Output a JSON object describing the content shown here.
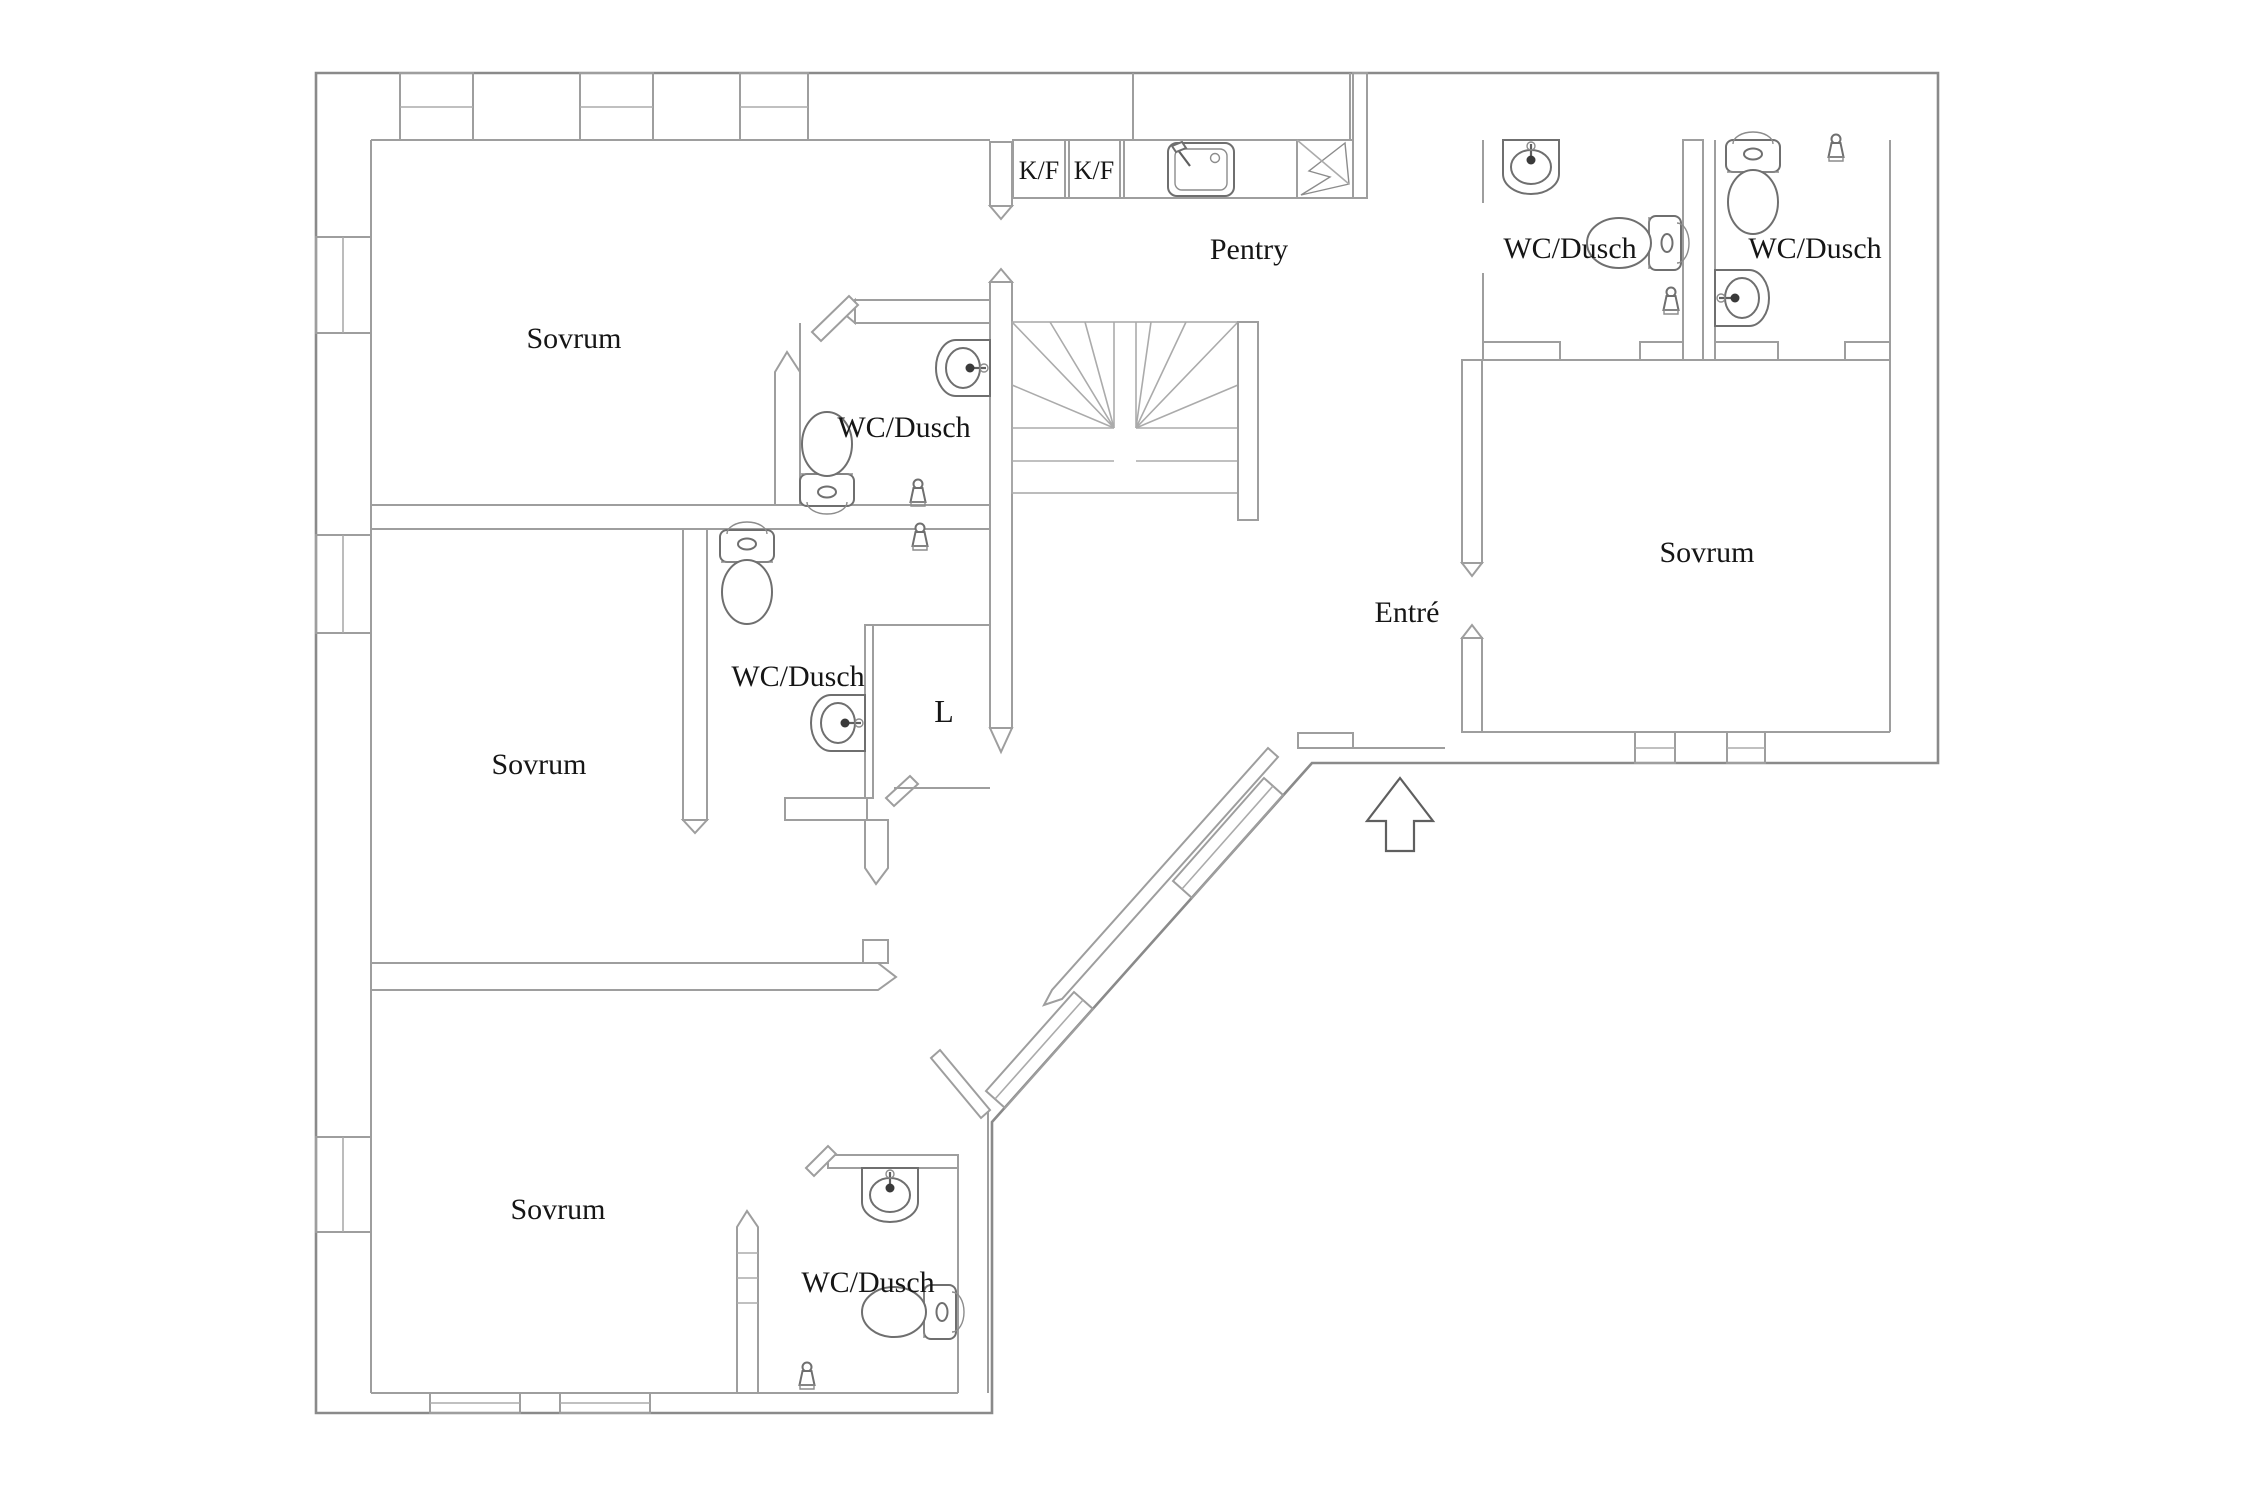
{
  "plan": {
    "type": "floor-plan",
    "language": "Swedish",
    "colors": {
      "background": "#ffffff",
      "wall": "#9e9e9e",
      "outer_wall": "#8a8a8a",
      "fixture": "#6f6f6f",
      "text": "#161616"
    },
    "labels": {
      "rooms": [
        {
          "id": "sovrum-top-left",
          "text": "Sovrum"
        },
        {
          "id": "sovrum-middle-left",
          "text": "Sovrum"
        },
        {
          "id": "sovrum-bottom",
          "text": "Sovrum"
        },
        {
          "id": "sovrum-right",
          "text": "Sovrum"
        },
        {
          "id": "wc-dusch-stairs",
          "text": "WC/Dusch"
        },
        {
          "id": "wc-dusch-middle",
          "text": "WC/Dusch"
        },
        {
          "id": "wc-dusch-bottom",
          "text": "WC/Dusch"
        },
        {
          "id": "wc-dusch-right-1",
          "text": "WC/Dusch"
        },
        {
          "id": "wc-dusch-right-2",
          "text": "WC/Dusch"
        },
        {
          "id": "pentry",
          "text": "Pentry"
        },
        {
          "id": "entre",
          "text": "Entré"
        },
        {
          "id": "closet",
          "text": "L"
        },
        {
          "id": "fridge-freezer-1",
          "text": "K/F"
        },
        {
          "id": "fridge-freezer-2",
          "text": "K/F"
        }
      ]
    },
    "fixtures": [
      "toilet-icon x5",
      "hand-basin-icon x5",
      "shower-mixer-icon x5",
      "kitchen-sink-icon",
      "stove-lightning-icon",
      "staircase",
      "entry-arrow-icon",
      "windows",
      "wardrobe-bays"
    ]
  }
}
